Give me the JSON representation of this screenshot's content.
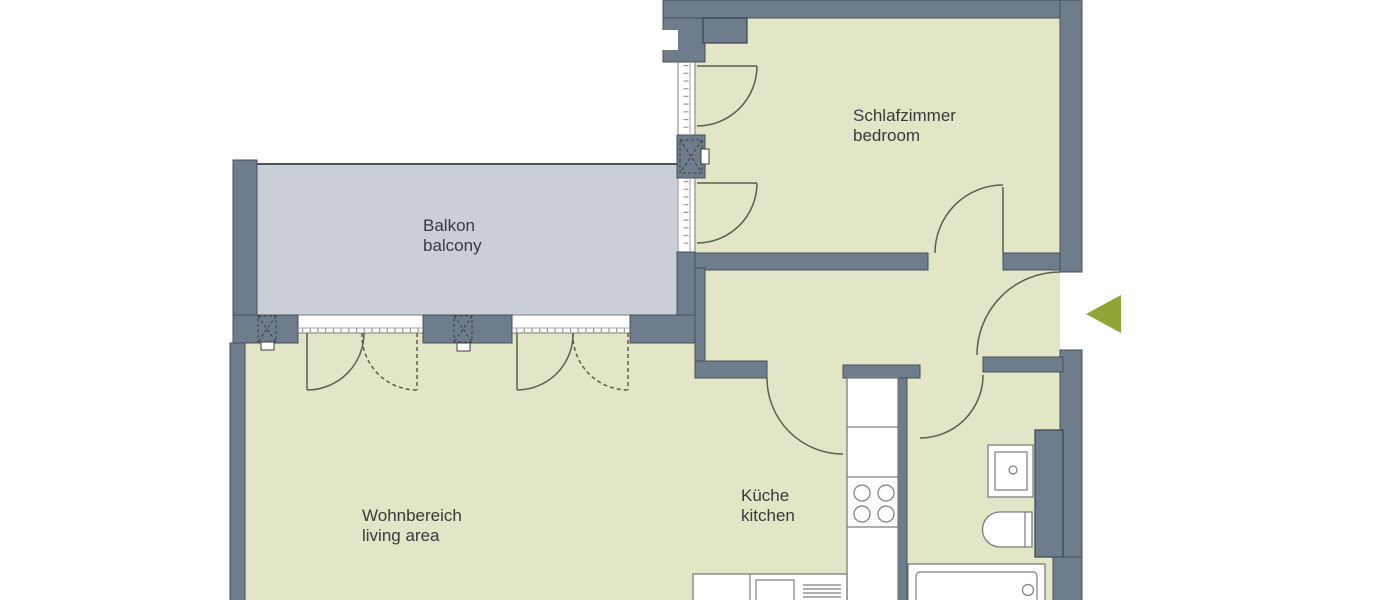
{
  "title": "Apartment floor plan",
  "colors": {
    "background": "#ffffff",
    "wall-fill": "#6e7c8b",
    "wall-stroke": "#45505a",
    "room-fill": "#e2e5c6",
    "balcony-fill": "#c9ced7",
    "door-stroke": "#57604f",
    "fixture-stroke": "#7d7d7d",
    "arrow-green": "#8ea635",
    "label-text": "#3a3a3a"
  },
  "rooms": {
    "bedroom": {
      "name_de": "Schlafzimmer",
      "name_en": "bedroom"
    },
    "balcony": {
      "name_de": "Balkon",
      "name_en": "balcony"
    },
    "living": {
      "name_de": "Wohnbereich",
      "name_en": "living area"
    },
    "kitchen": {
      "name_de": "Küche",
      "name_en": "kitchen"
    }
  },
  "fixtures": [
    "entrance-arrow",
    "bathtub",
    "toilet",
    "washbasin",
    "shaft",
    "kitchen-counter",
    "stove-burners",
    "kitchen-sink",
    "drainer",
    "french-door",
    "window",
    "downpipe-symbol",
    "chimney-block"
  ]
}
